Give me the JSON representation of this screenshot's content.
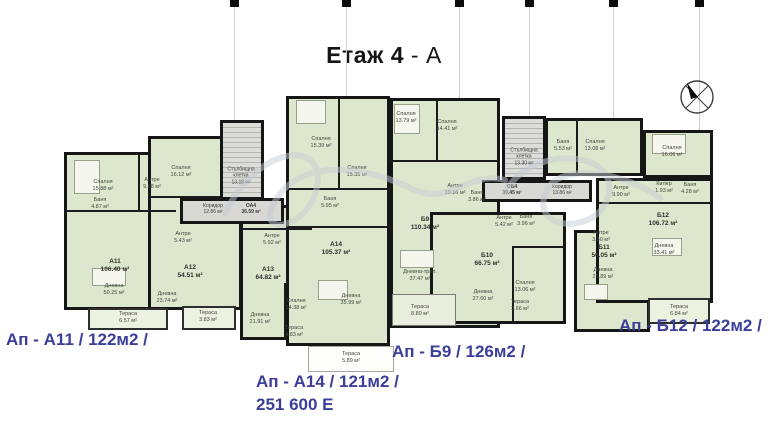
{
  "title": {
    "floor": "Етаж 4",
    "wing": " - А"
  },
  "captions": {
    "a11": "Ап - А11 / 122м2 /",
    "a14_line1": "Ап - А14 / 121м2 /",
    "a14_line2": "251 600 Е",
    "b9": "Ап - Б9 / 126м2 /",
    "b12": "Ап - Б12 / 122м2 /"
  },
  "units": {
    "a11": {
      "label": "А11\n106.40 м²",
      "rooms": {
        "bedroom": "Спалня\n15.88 м²",
        "bath": "Баня\n4.87 м²",
        "hall": "Антре\n9.88 м²",
        "living": "Дневна\n50.25 м²",
        "terrace": "Тераса\n6.57 м²"
      }
    },
    "a12": {
      "label": "А12\n54.51 м²",
      "rooms": {
        "bedroom": "Спалня\n16.12 м²",
        "hall": "Антре\n5.43 м²",
        "living": "Дневна\n23.74 м²",
        "terrace": "Тераса\n3.83 м²"
      }
    },
    "a13": {
      "label": "А13\n64.82 м²",
      "rooms": {
        "hall": "Антре\n5.92 м²",
        "bedroom": "Спалня\n14.38 м²",
        "living": "Дневна\n21.91 м²",
        "terrace": "Тераса\n4.83 м²"
      }
    },
    "a14": {
      "label": "А14\n105.37 м²",
      "rooms": {
        "bedroom1": "Спалня\n15.39 м²",
        "bedroom2": "Спалня\n15.35 м²",
        "bath": "Баня\n5.95 м²",
        "living": "Дневна\n35.99 м²",
        "terrace": "Тераса\n5.89 м²"
      }
    },
    "b9": {
      "label": "Б9\n110.34 м²",
      "rooms": {
        "bedroom1": "Спалня\n13.79 м²",
        "bedroom2": "Спалня\n14.41 м²",
        "hall": "Антре\n10.16 м²",
        "bath": "Баня\n3.86 м²",
        "living": "Дневна-трап.\n37.47 м²",
        "terrace": "Тераса\n8.80 м²"
      }
    },
    "b10": {
      "label": "Б10\n66.75 м²",
      "rooms": {
        "hall": "Антре\n5.42 м²",
        "bath": "Баня\n3.96 м²",
        "living": "Дневна\n27.60 м²",
        "bedroom": "Спалня\n13.06 м²",
        "terrace": "Тераса\n3.66 м²"
      }
    },
    "b11": {
      "label": "Б11\n56.05 м²",
      "rooms": {
        "hall": "Антре\n3.50 м²",
        "bath": "Баня\n5.53 м²",
        "bedroom": "Спалня\n13.08 м²",
        "living": "Дневна\n25.89 м²"
      }
    },
    "b12": {
      "label": "Б12\n106.72 м²",
      "rooms": {
        "hall": "Антре\n9.90 м²",
        "closet": "Килер\n1.93 м²",
        "bath": "Баня\n4.28 м²",
        "bedroom": "Спалня\n16.06 м²",
        "living": "Дневна\n33.41 м²",
        "terrace": "Тераса\n6.84 м²"
      }
    }
  },
  "common": {
    "stair_a": "Стълбищна\nклетка\n13.18 м²",
    "corridor_a": "Коридор\n12.86 м²",
    "oa4": "ОА4\n36.59 м²",
    "stair_b": "Стълбищна\nклетка\n13.30 м²",
    "corridor_b": "Коридор\n13.86 м²",
    "ob4": "ОБ4\n39.45 м²"
  },
  "colors": {
    "accent_blue": "#3c3e99",
    "room_green": "#dde7cd",
    "terrace_green": "#ecf2e0",
    "corridor_gray": "#d8d8d4",
    "wall_black": "#161616"
  }
}
